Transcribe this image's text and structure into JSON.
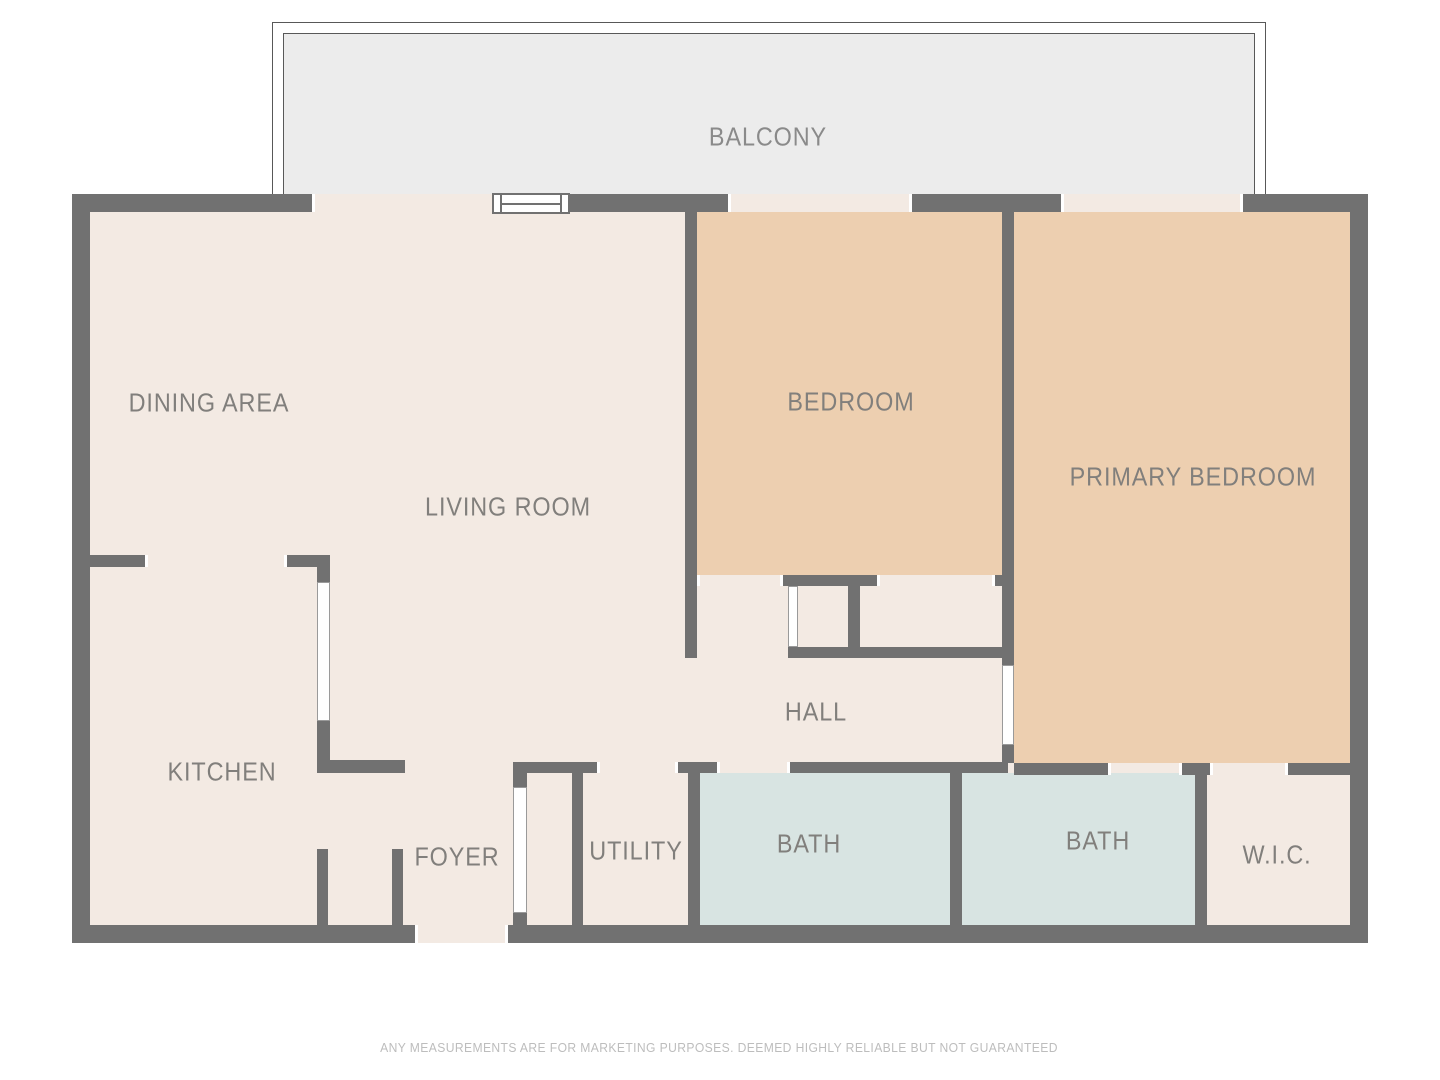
{
  "colors": {
    "wall": "#717171",
    "cream": "#f3eae3",
    "tan": "#edcfb0",
    "blue": "#d8e4e2",
    "balcony_fill": "#ececec",
    "balcony_line": "#585858",
    "door_white": "#ffffff",
    "room_label": "#817f7c",
    "balcony_label": "#8a8a8a",
    "disclaimer": "#bdbdbd"
  },
  "balcony": {
    "label": "BALCONY",
    "outer": [
      272,
      22,
      994,
      172
    ],
    "inner": [
      283,
      33,
      972,
      161
    ],
    "label_center": [
      768,
      137
    ]
  },
  "interior": [
    90,
    212,
    1260,
    713
  ],
  "room_fills": [
    {
      "id": "bedroom",
      "color": "tan",
      "r": [
        697,
        212,
        305,
        363
      ]
    },
    {
      "id": "primary-bedroom",
      "color": "tan",
      "r": [
        1014,
        212,
        336,
        551
      ]
    },
    {
      "id": "bath-1",
      "color": "blue",
      "r": [
        700,
        773,
        250,
        152
      ]
    },
    {
      "id": "bath-2",
      "color": "blue",
      "r": [
        962,
        773,
        233,
        152
      ]
    }
  ],
  "walls": [
    {
      "id": "exterior-top-a",
      "r": [
        72,
        194,
        240,
        18
      ]
    },
    {
      "id": "exterior-top-b",
      "r": [
        569,
        194,
        159,
        18
      ]
    },
    {
      "id": "exterior-top-c",
      "r": [
        912,
        194,
        149,
        18
      ]
    },
    {
      "id": "exterior-top-d",
      "r": [
        1243,
        194,
        125,
        18
      ]
    },
    {
      "id": "exterior-left",
      "r": [
        72,
        194,
        18,
        749
      ]
    },
    {
      "id": "exterior-right",
      "r": [
        1350,
        194,
        18,
        749
      ]
    },
    {
      "id": "exterior-bottom-a",
      "r": [
        72,
        925,
        343,
        18
      ]
    },
    {
      "id": "exterior-bottom-b",
      "r": [
        508,
        925,
        860,
        18
      ]
    },
    {
      "id": "living-bedroom-divider",
      "r": [
        685,
        212,
        12,
        446
      ]
    },
    {
      "id": "bedroom-south-a",
      "r": [
        783,
        575,
        94,
        11
      ]
    },
    {
      "id": "bedroom-south-b",
      "r": [
        995,
        575,
        19,
        11
      ]
    },
    {
      "id": "closet-divider",
      "r": [
        848,
        575,
        12,
        83
      ]
    },
    {
      "id": "closet-south",
      "r": [
        788,
        647,
        226,
        11
      ]
    },
    {
      "id": "bedrooms-divider-a",
      "r": [
        1002,
        212,
        12,
        453
      ]
    },
    {
      "id": "bedrooms-divider-b",
      "r": [
        1002,
        745,
        12,
        18
      ]
    },
    {
      "id": "hall-south-a",
      "r": [
        513,
        762,
        84,
        11
      ]
    },
    {
      "id": "hall-south-b",
      "r": [
        678,
        762,
        39,
        11
      ]
    },
    {
      "id": "hall-south-c",
      "r": [
        790,
        762,
        218,
        11
      ]
    },
    {
      "id": "primary-south-a",
      "r": [
        1014,
        763,
        94,
        12
      ]
    },
    {
      "id": "primary-south-b",
      "r": [
        1182,
        763,
        28,
        12
      ]
    },
    {
      "id": "primary-south-c",
      "r": [
        1288,
        763,
        62,
        12
      ]
    },
    {
      "id": "kitchen-north-a",
      "r": [
        90,
        555,
        55,
        12
      ]
    },
    {
      "id": "kitchen-north-b",
      "r": [
        287,
        555,
        43,
        12
      ]
    },
    {
      "id": "kitchen-east-a",
      "r": [
        317,
        555,
        13,
        27
      ]
    },
    {
      "id": "kitchen-east-b",
      "r": [
        317,
        721,
        13,
        52
      ]
    },
    {
      "id": "kitchen-arm",
      "r": [
        317,
        760,
        88,
        13
      ]
    },
    {
      "id": "foyer-stub-left",
      "r": [
        317,
        849,
        11,
        76
      ]
    },
    {
      "id": "foyer-stub-right",
      "r": [
        392,
        849,
        11,
        76
      ]
    },
    {
      "id": "foyer-closet-stub-a",
      "r": [
        513,
        773,
        14,
        14
      ]
    },
    {
      "id": "foyer-closet-stub-b",
      "r": [
        513,
        913,
        14,
        12
      ]
    },
    {
      "id": "foyer-utility-divider",
      "r": [
        572,
        762,
        11,
        163
      ]
    },
    {
      "id": "utility-bath-divider",
      "r": [
        688,
        762,
        12,
        163
      ]
    },
    {
      "id": "baths-divider",
      "r": [
        950,
        762,
        12,
        163
      ]
    },
    {
      "id": "bath-wic-divider",
      "r": [
        1195,
        763,
        12,
        162
      ]
    }
  ],
  "openings": [
    {
      "id": "window-left",
      "r": [
        312,
        194,
        180,
        18
      ]
    },
    {
      "id": "window-middle",
      "r": [
        728,
        194,
        184,
        18
      ]
    },
    {
      "id": "window-right",
      "r": [
        1061,
        194,
        182,
        18
      ]
    },
    {
      "id": "entry-door",
      "r": [
        415,
        925,
        93,
        18
      ]
    }
  ],
  "jambs": [
    {
      "r": [
        312,
        194,
        3,
        18
      ]
    },
    {
      "r": [
        728,
        194,
        3,
        18
      ]
    },
    {
      "r": [
        909,
        194,
        3,
        18
      ]
    },
    {
      "r": [
        1061,
        194,
        3,
        18
      ]
    },
    {
      "r": [
        1240,
        194,
        3,
        18
      ]
    },
    {
      "r": [
        415,
        925,
        3,
        18
      ]
    },
    {
      "r": [
        505,
        925,
        3,
        18
      ]
    },
    {
      "r": [
        145,
        555,
        3,
        12
      ]
    },
    {
      "r": [
        284,
        555,
        3,
        12
      ]
    },
    {
      "r": [
        697,
        575,
        3,
        11
      ]
    },
    {
      "r": [
        780,
        575,
        3,
        11
      ]
    },
    {
      "r": [
        877,
        575,
        3,
        11
      ]
    },
    {
      "r": [
        992,
        575,
        3,
        11
      ]
    },
    {
      "r": [
        597,
        762,
        3,
        11
      ]
    },
    {
      "r": [
        675,
        762,
        3,
        11
      ]
    },
    {
      "r": [
        717,
        762,
        3,
        11
      ]
    },
    {
      "r": [
        787,
        762,
        3,
        11
      ]
    },
    {
      "r": [
        1108,
        763,
        3,
        12
      ]
    },
    {
      "r": [
        1179,
        763,
        3,
        12
      ]
    },
    {
      "r": [
        1210,
        763,
        3,
        12
      ]
    },
    {
      "r": [
        1285,
        763,
        3,
        12
      ]
    }
  ],
  "doors": [
    {
      "id": "kitchen-pocket-door",
      "r": [
        317,
        582,
        13,
        139
      ]
    },
    {
      "id": "foyer-closet-door",
      "r": [
        513,
        787,
        14,
        126
      ]
    },
    {
      "id": "hall-closet-door",
      "r": [
        788,
        586,
        10,
        61
      ]
    },
    {
      "id": "primary-bedroom-door",
      "r": [
        1002,
        665,
        12,
        80
      ]
    }
  ],
  "window_symbol": {
    "r": [
      492,
      193,
      78,
      21
    ]
  },
  "room_labels": [
    {
      "text": "DINING AREA",
      "x": 209,
      "y": 403
    },
    {
      "text": "LIVING ROOM",
      "x": 508,
      "y": 507
    },
    {
      "text": "BEDROOM",
      "x": 851,
      "y": 402
    },
    {
      "text": "PRIMARY BEDROOM",
      "x": 1193,
      "y": 477
    },
    {
      "text": "KITCHEN",
      "x": 222,
      "y": 772
    },
    {
      "text": "FOYER",
      "x": 457,
      "y": 857
    },
    {
      "text": "UTILITY",
      "x": 636,
      "y": 851
    },
    {
      "text": "HALL",
      "x": 816,
      "y": 712
    },
    {
      "text": "BATH",
      "x": 809,
      "y": 844
    },
    {
      "text": "BATH",
      "x": 1098,
      "y": 841
    },
    {
      "text": "W.I.C.",
      "x": 1277,
      "y": 855
    }
  ],
  "disclaimer": {
    "text": "ANY MEASUREMENTS ARE FOR MARKETING PURPOSES. DEEMED HIGHLY RELIABLE BUT NOT GUARANTEED",
    "x": 719,
    "y": 1048
  }
}
